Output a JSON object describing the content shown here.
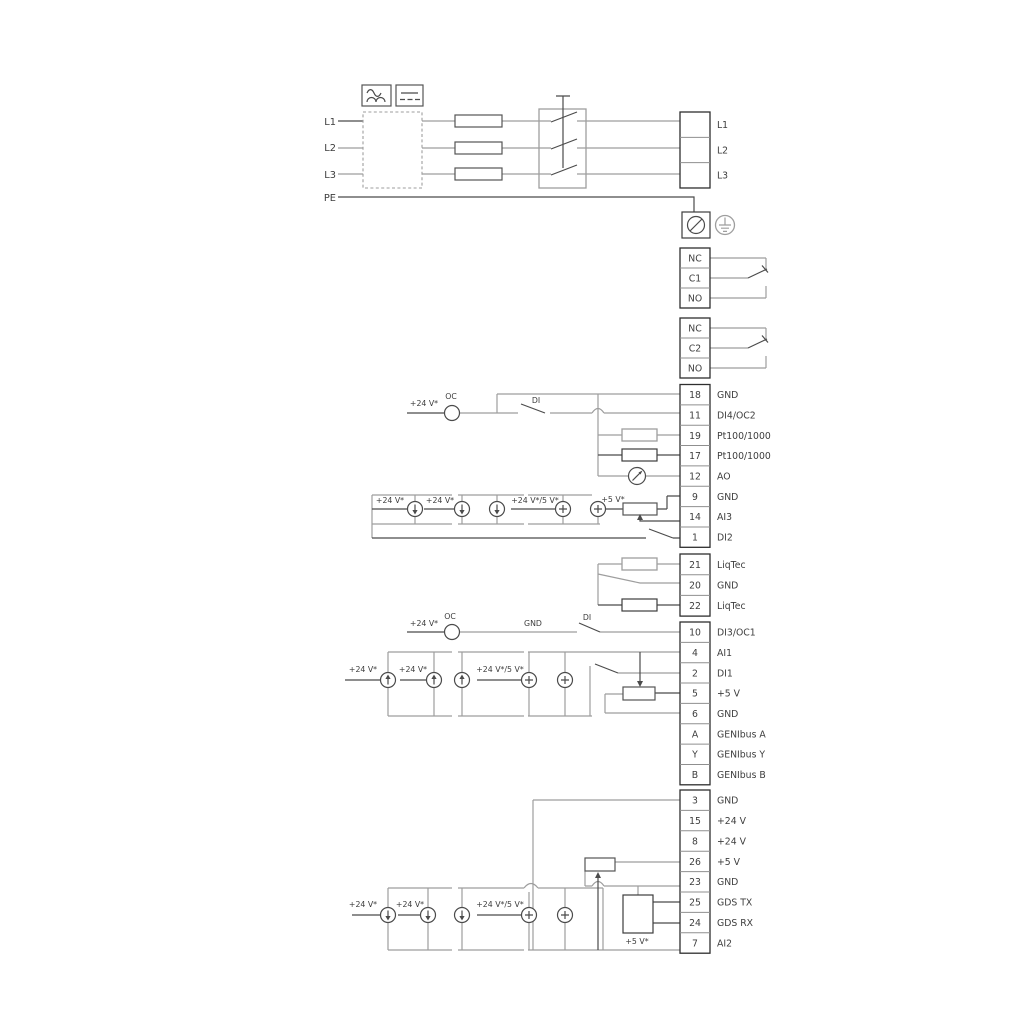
{
  "colors": {
    "wire_gray": "#9e9e9e",
    "wire_dark": "#4b4b4b",
    "text": "#3d3d3d"
  },
  "power": {
    "left_labels": [
      "L1",
      "L2",
      "L3",
      "PE"
    ]
  },
  "terminal_blocks": {
    "power_out": [
      [
        "",
        "L1"
      ],
      [
        "",
        "L2"
      ],
      [
        "",
        "L3"
      ]
    ],
    "relay1": [
      [
        "NC",
        ""
      ],
      [
        "C1",
        ""
      ],
      [
        "NO",
        ""
      ]
    ],
    "relay2": [
      [
        "NC",
        ""
      ],
      [
        "C2",
        ""
      ],
      [
        "NO",
        ""
      ]
    ],
    "io1": [
      [
        "18",
        "GND"
      ],
      [
        "11",
        "DI4/OC2"
      ],
      [
        "19",
        "Pt100/1000"
      ],
      [
        "17",
        "Pt100/1000"
      ],
      [
        "12",
        "AO"
      ],
      [
        "9",
        "GND"
      ],
      [
        "14",
        "AI3"
      ],
      [
        "1",
        "DI2"
      ]
    ],
    "liqtec": [
      [
        "21",
        "LiqTec"
      ],
      [
        "20",
        "GND"
      ],
      [
        "22",
        "LiqTec"
      ]
    ],
    "io2": [
      [
        "10",
        "DI3/OC1"
      ],
      [
        "4",
        "AI1"
      ],
      [
        "2",
        "DI1"
      ],
      [
        "5",
        "+5 V"
      ],
      [
        "6",
        "GND"
      ],
      [
        "A",
        "GENIbus A"
      ],
      [
        "Y",
        "GENIbus Y"
      ],
      [
        "B",
        "GENIbus B"
      ]
    ],
    "io3": [
      [
        "3",
        "GND"
      ],
      [
        "15",
        "+24 V"
      ],
      [
        "8",
        "+24 V"
      ],
      [
        "26",
        "+5 V"
      ],
      [
        "23",
        "GND"
      ],
      [
        "25",
        "GDS TX"
      ],
      [
        "24",
        "GDS RX"
      ],
      [
        "7",
        "AI2"
      ]
    ]
  },
  "annotations": {
    "oc_feed_1": "+24 V*",
    "oc_1": "OC",
    "di_1": "DI",
    "ai3_24v_1": "+24 V*",
    "ai3_24v_2": "+24 V*",
    "ai3_24v5v": "+24 V*/5 V*",
    "ai3_5v": "+5 V*",
    "oc_feed_2": "+24 V*",
    "oc_2": "OC",
    "gnd_wire": "GND",
    "di_2": "DI",
    "ai1_24v_1": "+24 V*",
    "ai1_24v_2": "+24 V*",
    "ai1_24v5v": "+24 V*/5 V*",
    "ai2_24v_1": "+24 V*",
    "ai2_24v_2": "+24 V*",
    "ai2_24v5v": "+24 V*/5 V*",
    "ai2_5v": "+5 V*"
  }
}
